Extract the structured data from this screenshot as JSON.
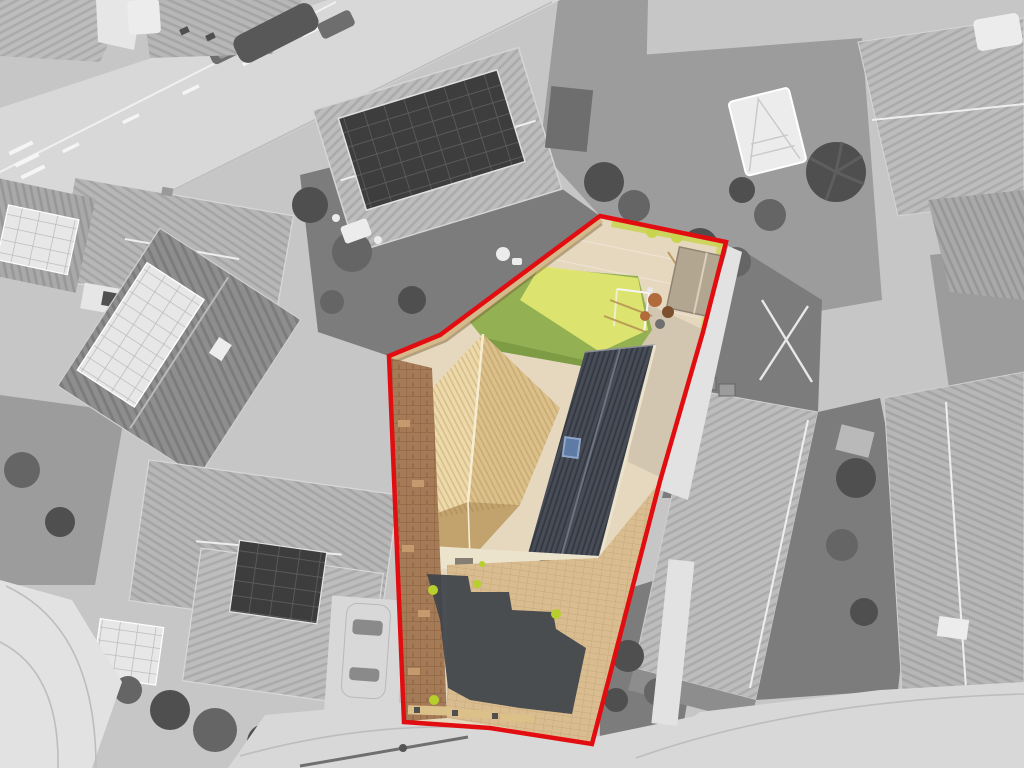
{
  "meta": {
    "type": "aerial-property-photograph",
    "description": "Overhead drone photo of a residential street; surroundings desaturated to grayscale, the marketed property shown in full colour and outlined with a red boundary line"
  },
  "scene": {
    "boundary": {
      "color": "#e20d10",
      "stroke_width": "4.5",
      "points": "600,216 726,242 703,332 660,481 592,744 490,728 404,722 389,356 440,335"
    },
    "colors": {
      "patio_beige": "#e5d8bf",
      "corridor_gray": "#cfc4ae",
      "fence_tan": "#d4b98b",
      "lawn_green": "#93b052",
      "lawn_bright": "#e0e671",
      "lawn_dark": "#7d9c44",
      "roof_tan": "#dcc08a",
      "roof_tan_light": "#edd9a9",
      "roof_tan_shade": "#c2a36d",
      "roof_ridge_cream": "#f6ecd2",
      "roof_dark": "#474c57",
      "roof_dark_ridge": "#6d7380",
      "skylight_blue": "#5e7ba6",
      "skylight_frame": "#8fa7c8",
      "wall_cream": "#ece3cd",
      "paving_tan": "#d9bd90",
      "shadow_dark": "#3e434b",
      "brick_brown": "#a57b57",
      "brick_light": "#c59a6e",
      "plant_green": "#b6cf2c",
      "bush_yellow": "#c9d44e",
      "shed_gray": "#b2a691",
      "shed_side": "#978b79",
      "item_orange": "#b06a3c",
      "item_brown": "#7c4f2e"
    },
    "surroundings": {
      "base_gray": "#c6c6c6",
      "road_gray": "#d8d8d8",
      "solar_dark": "#3d3d3d",
      "solar_light": "#e7e7e7"
    },
    "regions": [
      {
        "name": "red-boundary-overlay",
        "color": "#e20d10"
      },
      {
        "name": "rear-garden-lawn",
        "color": "#93b052"
      },
      {
        "name": "lawn-sunlit-patch",
        "color": "#e0e671"
      },
      {
        "name": "patio-paving",
        "color": "#e5d8bf"
      },
      {
        "name": "timber-fence",
        "color": "#d4b98b"
      },
      {
        "name": "front-hipped-roof",
        "color": "#dcc08a"
      },
      {
        "name": "main-slate-roof",
        "color": "#474c57"
      },
      {
        "name": "roof-skylight",
        "color": "#5e7ba6"
      },
      {
        "name": "driveway-block-paving",
        "color": "#d9bd90"
      },
      {
        "name": "house-shadow-on-drive",
        "color": "#3e434b"
      },
      {
        "name": "brick-edging-path",
        "color": "#a57b57"
      },
      {
        "name": "garden-shed",
        "color": "#b2a691"
      },
      {
        "name": "yellow-shrubs",
        "color": "#c9d44e"
      }
    ]
  }
}
